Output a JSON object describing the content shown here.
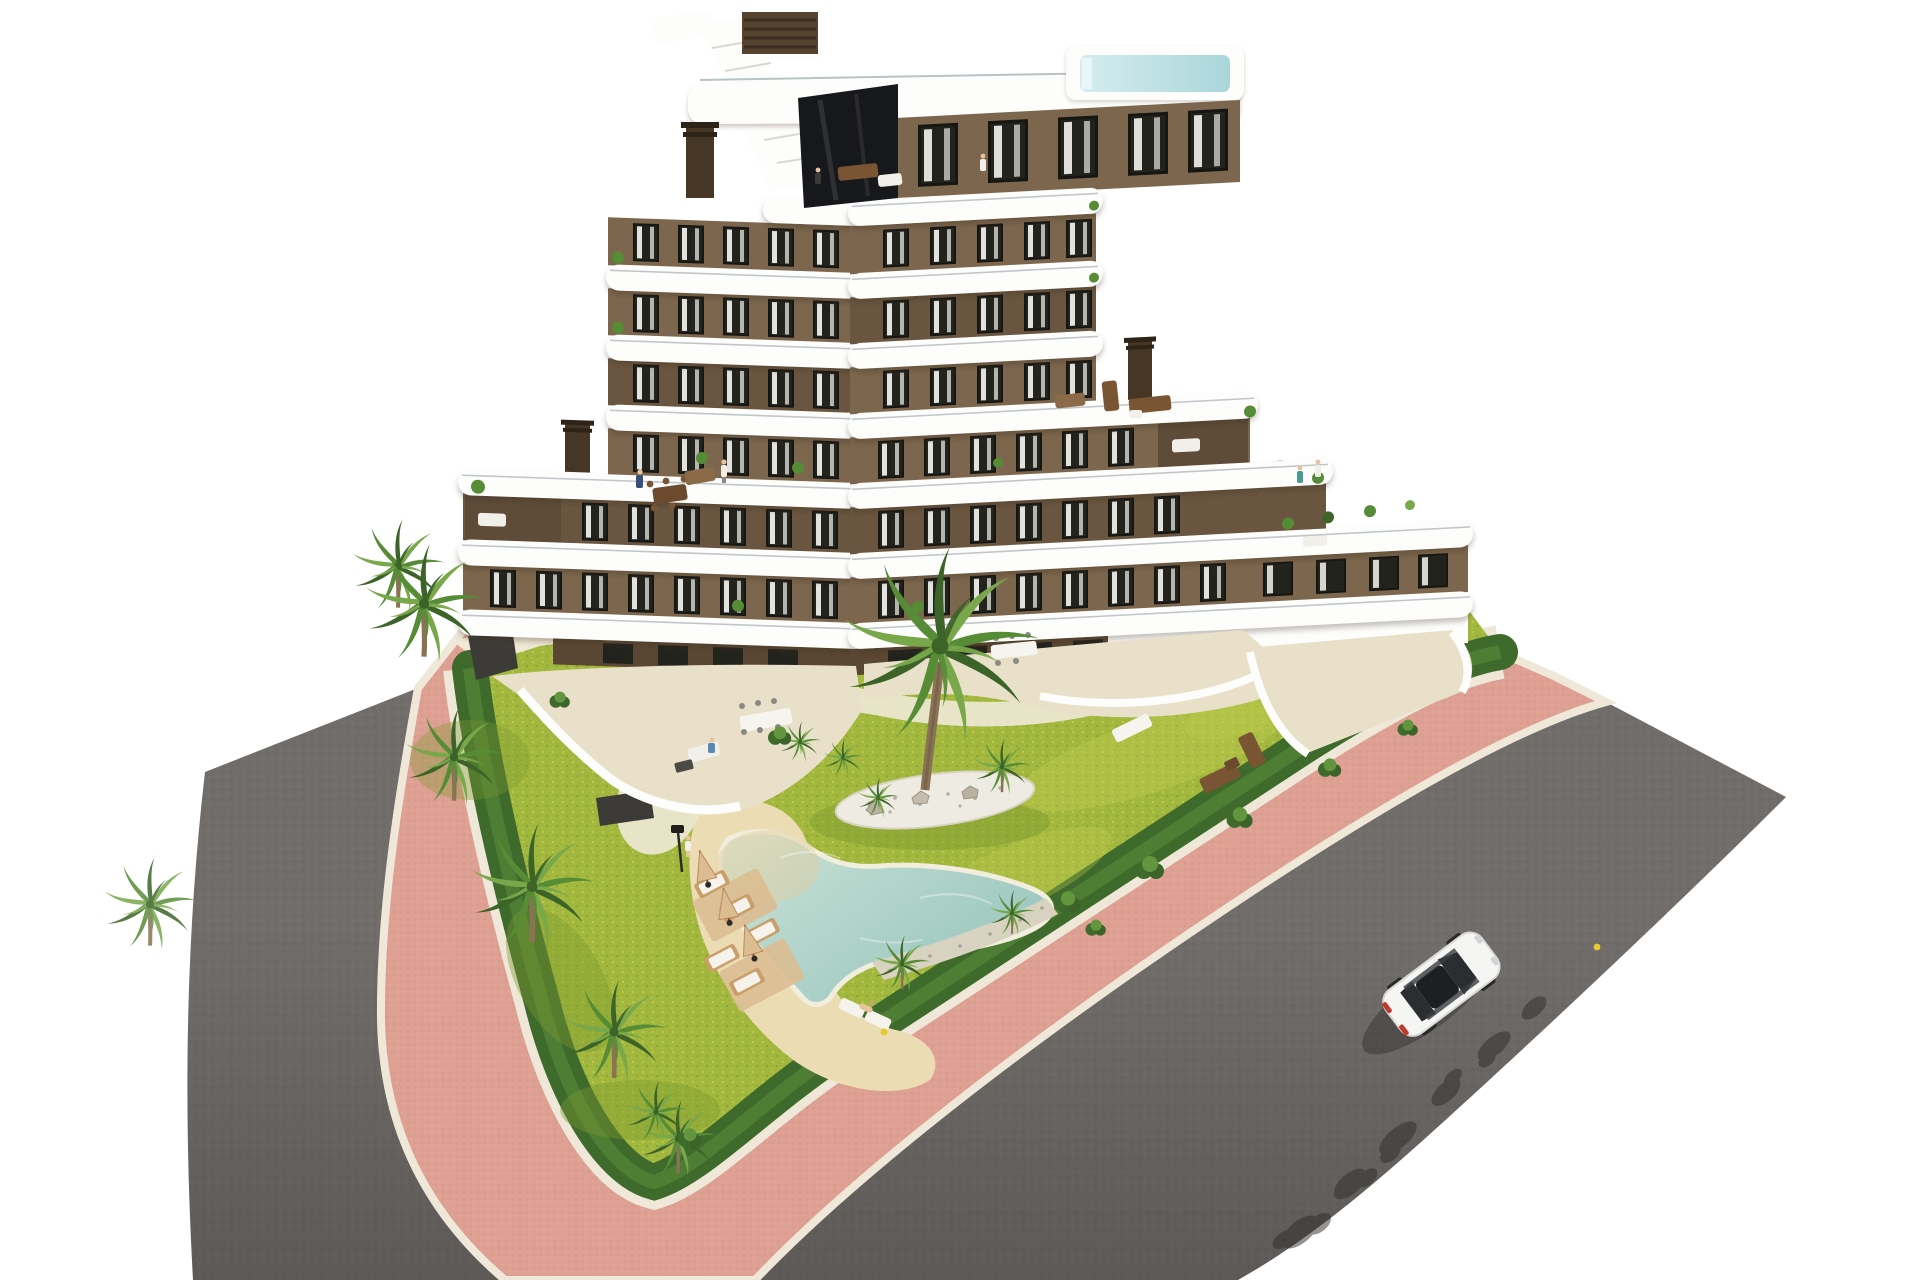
{
  "scene": {
    "kind": "aerial-architectural-render",
    "description": "Aerial 3D render of a modern terraced apartment building in white and brown, with rooftop plunge pool, zig-zag balcony slabs, landscaped garden with free-form swimming pool, sun loungers, palm trees, a pink pedestrian path with white curbs, two asphalt roads and a single white car",
    "width_px": 1920,
    "height_px": 1280
  },
  "palette": {
    "bg": "#ffffff",
    "roadBase": "#716d6a",
    "roadDot": "#7d7976",
    "roadDark": "#56524f",
    "roadLight": "#8a8683",
    "curb": "#efe8d8",
    "pinkBase": "#dda093",
    "pinkDot": "#cf8d7e",
    "pinkLight": "#e8b2a4",
    "hedge": "#3e6a2c",
    "hedgeLight": "#62953e",
    "lawnBase": "#a2b73d",
    "lawnDot": "#c3ce52",
    "lawnShade": "#7c9930",
    "sand": "#ecdcb4",
    "sandDeep": "#dfcb9d",
    "gravel": "#d8d3c1",
    "gravelDot": "#a9a396",
    "waterLight": "#e0e7d6",
    "waterMid": "#b9d8ce",
    "waterDeep": "#98c5bd",
    "waterRim": "#f1eedd",
    "deck": "#efe9d6",
    "terrace": "#e8e0c8",
    "white": "#fdfdfc",
    "brown": "#7c664d",
    "brownDark": "#6a5640",
    "brownShadow": "#5e4b38",
    "brownGround": "#5a4733",
    "windowDark": "#23231d",
    "frame": "#161613",
    "curtain": "#f4f3ef",
    "glassRail": "#b9c2c5",
    "chimney": "#453625",
    "mesh": "#3c3b37",
    "woodDark": "#6b4a2e",
    "woodMid": "#c99e69",
    "woodLight": "#dcbd92",
    "palmDark": "#3c6428",
    "palmMid": "#578c37",
    "palmLight": "#79a84b",
    "trunk": "#8a7355",
    "carBody": "#f5f5f3",
    "carShade": "#d9d9d5",
    "carGlass": "#2b2e31",
    "tailRed": "#c03a2e",
    "shadowTree": "#2e2c29",
    "skin": "#e8c49e",
    "blue": "#35507c",
    "teal": "#4a9a96",
    "yellow": "#e6c832",
    "dark": "#3a3a38",
    "poolTop": "#a9d6da",
    "poolTop2": "#d6edef"
  },
  "building": {
    "floors_visible": 7,
    "penthouse": true,
    "rooftop_plunge_pool": true,
    "rooftop_staircase": true,
    "chimneys": 3,
    "facade": [
      "white rounded slabs",
      "brown stucco walls",
      "dark framed windows with white curtains"
    ]
  },
  "garden": {
    "free_form_pool": true,
    "pool_beach_entry": true,
    "sun_loungers": 7,
    "umbrellas": 3,
    "palm_trees": 15,
    "pebble_island": true,
    "perimeter_hedge": true,
    "lamp_posts": 1
  },
  "streets": {
    "left_road": "asphalt",
    "right_road": "asphalt with tree shadows",
    "pedestrian_path": "salmon-pink pavers with white curbs wrapping the corner plot",
    "car": {
      "color": "white",
      "type": "coupe",
      "location": "right road, lower half, heading upper-right"
    }
  },
  "people_visible": 9
}
